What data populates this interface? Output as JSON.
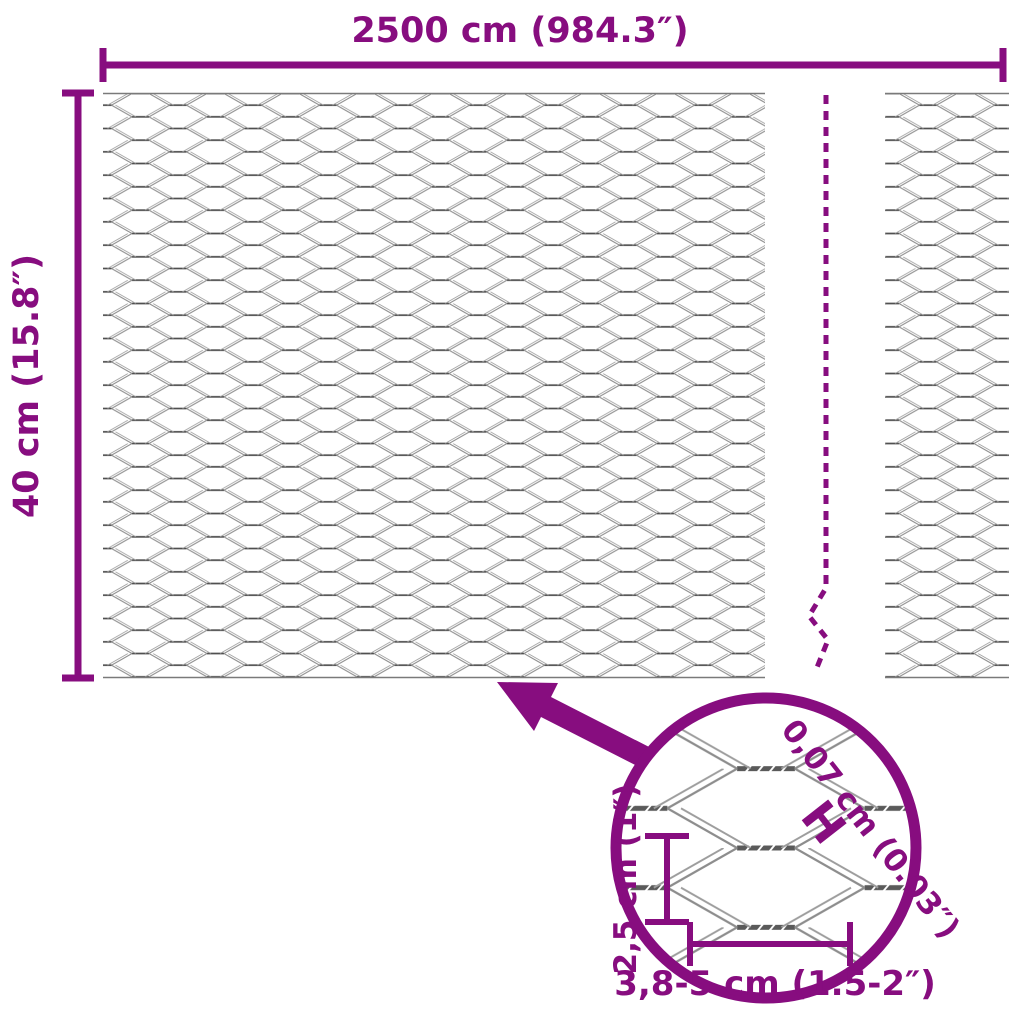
{
  "diagram_title": "wire-mesh-fence-dimension-diagram",
  "colors": {
    "accent": "#870D7F",
    "mesh_wire": "#8F8F8F",
    "mesh_twist": "#4F4F4F",
    "background": "#FFFFFF"
  },
  "dimensions": {
    "width_label": "2500 cm (984.3″)",
    "height_label": "40 cm (15.8″)"
  },
  "detail": {
    "wire_thickness_label": "0,07 cm (0.03″)",
    "wire_thickness_symbol": "H",
    "cell_height_label": "2,5 cm (1″)",
    "cell_width_label": "3,8-5 cm (1.5-2″)"
  }
}
